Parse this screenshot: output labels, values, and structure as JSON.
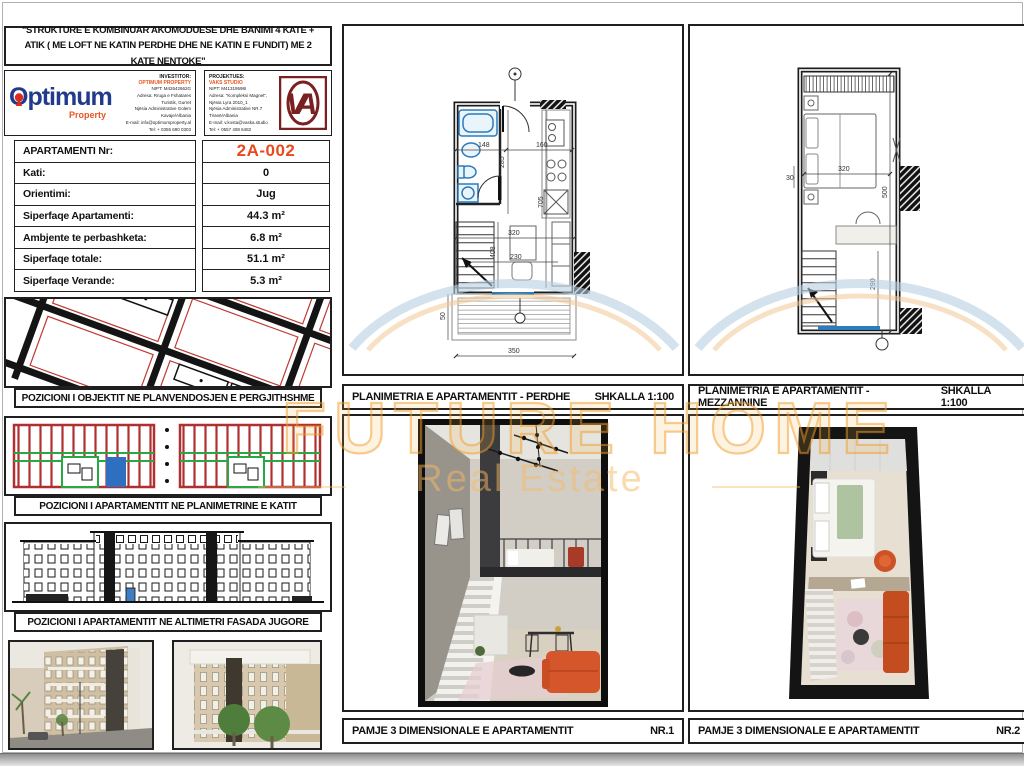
{
  "sheet": {
    "title": "\"STRUKTURE E KOMBINUAR AKOMODUESE DHE BANIMI 4 KATE + ATIK ( ME LOFT NE KATIN PERDHE DHE NE KATIN E FUNDIT) ME 2 KATE NENTOKE\""
  },
  "logo": {
    "name": "Optimum",
    "tagline": "Property",
    "monogram": "VA"
  },
  "investor": {
    "label": "INVESTITOR:",
    "company": "OPTIMUM PROPERTY",
    "details": "NIPT: M42642662G\nAdresa: Rruga e Fshatares\nTuristik, Gurret\nNjësia Administrative Golem\nKavaje/Albania\nE-mail: info@optimumproperty.al\nTel: + 0355 690 0303"
  },
  "designer": {
    "label": "PROJEKTUES:",
    "company": "VAKS STUDIO",
    "details": "NIPT: M41319598I\nAdresa: \"Kompleksi Magnet\",\nNjësia Lyra 2010_1\nNjësia Administrative NR.7\nTiranë/Albania\nE-mail: v.kosta@vaska.studio\nTel: + 0557 408 6482"
  },
  "info_table": {
    "rows": [
      {
        "label": "APARTAMENTI Nr:",
        "value": "2A-002"
      },
      {
        "label": "Kati:",
        "value": "0"
      },
      {
        "label": "Orientimi:",
        "value": "Jug"
      },
      {
        "label": "Siperfaqe Apartamenti:",
        "value": "44.3 m²"
      },
      {
        "label": "Ambjente te perbashketa:",
        "value": "6.8 m²"
      },
      {
        "label": "Siperfaqe totale:",
        "value": "51.1 m²"
      },
      {
        "label": "Siperfaqe Verande:",
        "value": "5.3 m²"
      }
    ]
  },
  "captions": {
    "site": "POZICIONI I OBJEKTIT NE PLANVENDOSJEN E PERGJITHSHME",
    "key": "POZICIONI I APARTAMENTIT  NE PLANIMETRINE E KATIT",
    "elevation": "POZICIONI I APARTAMENTIT NE ALTIMETRI  FASADA JUGORE",
    "plan_ground_title": "PLANIMETRIA E APARTAMENTIT - PERDHE",
    "plan_mezz_title": "PLANIMETRIA E APARTAMENTIT - MEZZANNINE",
    "scale": "SHKALLA 1:100",
    "view3d_title": "PAMJE 3 DIMENSIONALE E APARTAMENTIT",
    "nr1": "NR.1",
    "nr2": "NR.2"
  },
  "plans": {
    "ground_dims": [
      "148",
      "160",
      "285",
      "705",
      "320",
      "230",
      "408",
      "350",
      "50"
    ],
    "mezz_dims": [
      "320",
      "500",
      "290",
      "30"
    ]
  },
  "watermark": {
    "brand": "FUTURE HOME",
    "tagline": "Real Estate",
    "color": "#f0a137"
  }
}
